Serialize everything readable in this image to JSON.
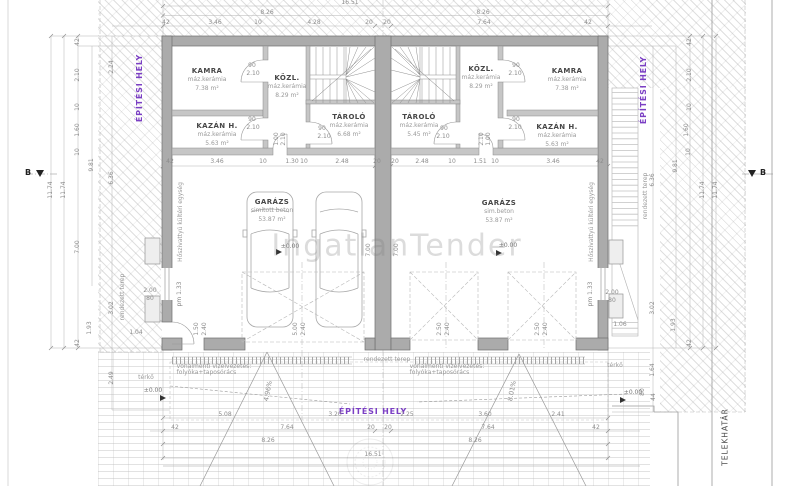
{
  "watermark": {
    "text": "IngatlanTender"
  },
  "site": {
    "epitesi_hely": "ÉPÍTÉSI HELY",
    "telekhatar": "TELEKHATÁR",
    "section_label": "B"
  },
  "rooms": {
    "left": {
      "kamra": {
        "name": "KAMRA",
        "finish": "máz.kerámia",
        "area": "7.38 m²"
      },
      "kozl": {
        "name": "KÖZL.",
        "finish": "máz.kerámia",
        "area": "8.29 m²"
      },
      "kazan": {
        "name": "KAZÁN H.",
        "finish": "máz.kerámia",
        "area": "5.63 m²"
      },
      "tarolo": {
        "name": "TÁROLÓ",
        "finish": "máz.kerámia",
        "area": "6.68 m²"
      },
      "garazs": {
        "name": "GARÁZS",
        "finish": "simított beton",
        "area": "53.87 m²"
      }
    },
    "right": {
      "kozl": {
        "name": "KÖZL.",
        "finish": "máz.kerámia",
        "area": "8.29 m²"
      },
      "kamra": {
        "name": "KAMRA",
        "finish": "máz.kerámia",
        "area": "7.38 m²"
      },
      "tarolo": {
        "name": "TÁROLÓ",
        "finish": "máz.kerámia",
        "area": "5.45 m²"
      },
      "kazan": {
        "name": "KAZÁN H.",
        "finish": "máz.kerámia",
        "area": "5.63 m²"
      },
      "garazs": {
        "name": "GARÁZS",
        "finish": "sim.beton",
        "area": "53.87 m²"
      }
    }
  },
  "annotations": {
    "zero_level": "±0.00",
    "drain_line1": "vonalmenti vízelvezetés:",
    "drain_line2": "folyóka+taposórács",
    "slope_left": "4.96%",
    "slope_right": "8.01%",
    "rendezett_terep": "rendezett terep",
    "terko": "térkő",
    "heatpump": "Hőszivattyú kültéri egység"
  },
  "dim_labels": [
    {
      "t": "16.51",
      "x": 350,
      "y": 3
    },
    {
      "t": "8.26",
      "x": 267,
      "y": 13
    },
    {
      "t": "8.26",
      "x": 483,
      "y": 13
    },
    {
      "t": "42",
      "x": 166,
      "y": 23
    },
    {
      "t": "3.46",
      "x": 215,
      "y": 23
    },
    {
      "t": "10",
      "x": 258,
      "y": 23
    },
    {
      "t": "4.28",
      "x": 314,
      "y": 23
    },
    {
      "t": "20",
      "x": 369,
      "y": 23
    },
    {
      "t": "20",
      "x": 387,
      "y": 23
    },
    {
      "t": "7.64",
      "x": 484,
      "y": 23
    },
    {
      "t": "42",
      "x": 588,
      "y": 23
    },
    {
      "t": "42",
      "x": 170,
      "y": 162
    },
    {
      "t": "3.46",
      "x": 217,
      "y": 162
    },
    {
      "t": "10",
      "x": 263,
      "y": 162
    },
    {
      "t": "1.30",
      "x": 292,
      "y": 162
    },
    {
      "t": "10",
      "x": 304,
      "y": 162
    },
    {
      "t": "2.48",
      "x": 342,
      "y": 162
    },
    {
      "t": "20",
      "x": 377,
      "y": 162
    },
    {
      "t": "20",
      "x": 395,
      "y": 162
    },
    {
      "t": "2.48",
      "x": 422,
      "y": 162
    },
    {
      "t": "10",
      "x": 452,
      "y": 162
    },
    {
      "t": "1.51",
      "x": 480,
      "y": 162
    },
    {
      "t": "10",
      "x": 495,
      "y": 162
    },
    {
      "t": "3.46",
      "x": 553,
      "y": 162
    },
    {
      "t": "42",
      "x": 600,
      "y": 162
    },
    {
      "t": "5.08",
      "x": 225,
      "y": 415
    },
    {
      "t": "3.20",
      "x": 335,
      "y": 415
    },
    {
      "t": "2.25",
      "x": 407,
      "y": 415
    },
    {
      "t": "3.60",
      "x": 485,
      "y": 415
    },
    {
      "t": "2.41",
      "x": 558,
      "y": 415
    },
    {
      "t": "42",
      "x": 175,
      "y": 428
    },
    {
      "t": "7.64",
      "x": 287,
      "y": 428
    },
    {
      "t": "20",
      "x": 371,
      "y": 428
    },
    {
      "t": "20",
      "x": 388,
      "y": 428
    },
    {
      "t": "7.64",
      "x": 488,
      "y": 428
    },
    {
      "t": "42",
      "x": 596,
      "y": 428
    },
    {
      "t": "8.26",
      "x": 268,
      "y": 441
    },
    {
      "t": "8.26",
      "x": 475,
      "y": 441
    },
    {
      "t": "16.51",
      "x": 373,
      "y": 455
    },
    {
      "t": "11.74",
      "x": 51,
      "y": 190,
      "v": 1
    },
    {
      "t": "11.74",
      "x": 64,
      "y": 190,
      "v": 1
    },
    {
      "t": "42",
      "x": 78,
      "y": 42,
      "v": 1
    },
    {
      "t": "2.10",
      "x": 78,
      "y": 75,
      "v": 1
    },
    {
      "t": "10",
      "x": 78,
      "y": 107,
      "v": 1
    },
    {
      "t": "1.60",
      "x": 78,
      "y": 130,
      "v": 1
    },
    {
      "t": "10",
      "x": 78,
      "y": 152,
      "v": 1
    },
    {
      "t": "2.24",
      "x": 112,
      "y": 67,
      "v": 1
    },
    {
      "t": "9.81",
      "x": 92,
      "y": 165,
      "v": 1
    },
    {
      "t": "6.36",
      "x": 112,
      "y": 178,
      "v": 1
    },
    {
      "t": "7.00",
      "x": 78,
      "y": 247,
      "v": 1
    },
    {
      "t": "3.02",
      "x": 112,
      "y": 308,
      "v": 1
    },
    {
      "t": "1.93",
      "x": 90,
      "y": 328,
      "v": 1
    },
    {
      "t": "42",
      "x": 78,
      "y": 343,
      "v": 1
    },
    {
      "t": "2.49",
      "x": 112,
      "y": 378,
      "v": 1
    },
    {
      "t": "2.00",
      "x": 150,
      "y": 291
    },
    {
      "t": "80",
      "x": 150,
      "y": 299
    },
    {
      "t": "1.04",
      "x": 136,
      "y": 333
    },
    {
      "t": "pm 1.33",
      "x": 180,
      "y": 294,
      "v": 1
    },
    {
      "t": "1.50",
      "x": 197,
      "y": 329,
      "v": 1
    },
    {
      "t": "2.40",
      "x": 205,
      "y": 329,
      "v": 1
    },
    {
      "t": "42",
      "x": 690,
      "y": 42,
      "v": 1
    },
    {
      "t": "2.10",
      "x": 690,
      "y": 75,
      "v": 1
    },
    {
      "t": "10",
      "x": 690,
      "y": 107,
      "v": 1
    },
    {
      "t": "1.60",
      "x": 687,
      "y": 130,
      "v": 1
    },
    {
      "t": "10",
      "x": 689,
      "y": 152,
      "v": 1
    },
    {
      "t": "9.81",
      "x": 676,
      "y": 166,
      "v": 1
    },
    {
      "t": "6.36",
      "x": 653,
      "y": 180,
      "v": 1
    },
    {
      "t": "11.74",
      "x": 703,
      "y": 190,
      "v": 1
    },
    {
      "t": "11.74",
      "x": 716,
      "y": 190,
      "v": 1
    },
    {
      "t": "3.02",
      "x": 653,
      "y": 308,
      "v": 1
    },
    {
      "t": "1.93",
      "x": 674,
      "y": 325,
      "v": 1
    },
    {
      "t": "42",
      "x": 690,
      "y": 343,
      "v": 1
    },
    {
      "t": "1.64",
      "x": 653,
      "y": 370,
      "v": 1
    },
    {
      "t": "80",
      "x": 643,
      "y": 392,
      "v": 1
    },
    {
      "t": "44",
      "x": 654,
      "y": 397,
      "v": 1
    },
    {
      "t": "1.06",
      "x": 620,
      "y": 325
    },
    {
      "t": "2.00",
      "x": 612,
      "y": 293
    },
    {
      "t": "80",
      "x": 612,
      "y": 301
    },
    {
      "t": "pm 1.33",
      "x": 591,
      "y": 294,
      "v": 1
    },
    {
      "t": "5.00",
      "x": 296,
      "y": 329,
      "v": 1
    },
    {
      "t": "2.40",
      "x": 304,
      "y": 329,
      "v": 1
    },
    {
      "t": "2.50",
      "x": 440,
      "y": 329,
      "v": 1
    },
    {
      "t": "2.40",
      "x": 448,
      "y": 329,
      "v": 1
    },
    {
      "t": "2.50",
      "x": 538,
      "y": 329,
      "v": 1
    },
    {
      "t": "2.40",
      "x": 546,
      "y": 329,
      "v": 1
    },
    {
      "t": "90",
      "x": 252,
      "y": 66
    },
    {
      "t": "2.10",
      "x": 253,
      "y": 74
    },
    {
      "t": "90",
      "x": 252,
      "y": 120
    },
    {
      "t": "2.10",
      "x": 253,
      "y": 128
    },
    {
      "t": "90",
      "x": 322,
      "y": 129
    },
    {
      "t": "2.10",
      "x": 324,
      "y": 137
    },
    {
      "t": "90",
      "x": 516,
      "y": 66
    },
    {
      "t": "2.10",
      "x": 515,
      "y": 74
    },
    {
      "t": "90",
      "x": 516,
      "y": 120
    },
    {
      "t": "2.10",
      "x": 515,
      "y": 128
    },
    {
      "t": "90",
      "x": 444,
      "y": 129
    },
    {
      "t": "2.10",
      "x": 443,
      "y": 137
    },
    {
      "t": "1.00",
      "x": 277,
      "y": 139,
      "v": 1
    },
    {
      "t": "2.10",
      "x": 284,
      "y": 139,
      "v": 1
    },
    {
      "t": "1.00",
      "x": 489,
      "y": 139,
      "v": 1
    },
    {
      "t": "2.10",
      "x": 482,
      "y": 139,
      "v": 1
    },
    {
      "t": "7.00",
      "x": 369,
      "y": 250,
      "v": 1
    },
    {
      "t": "7.00",
      "x": 397,
      "y": 250,
      "v": 1
    }
  ]
}
